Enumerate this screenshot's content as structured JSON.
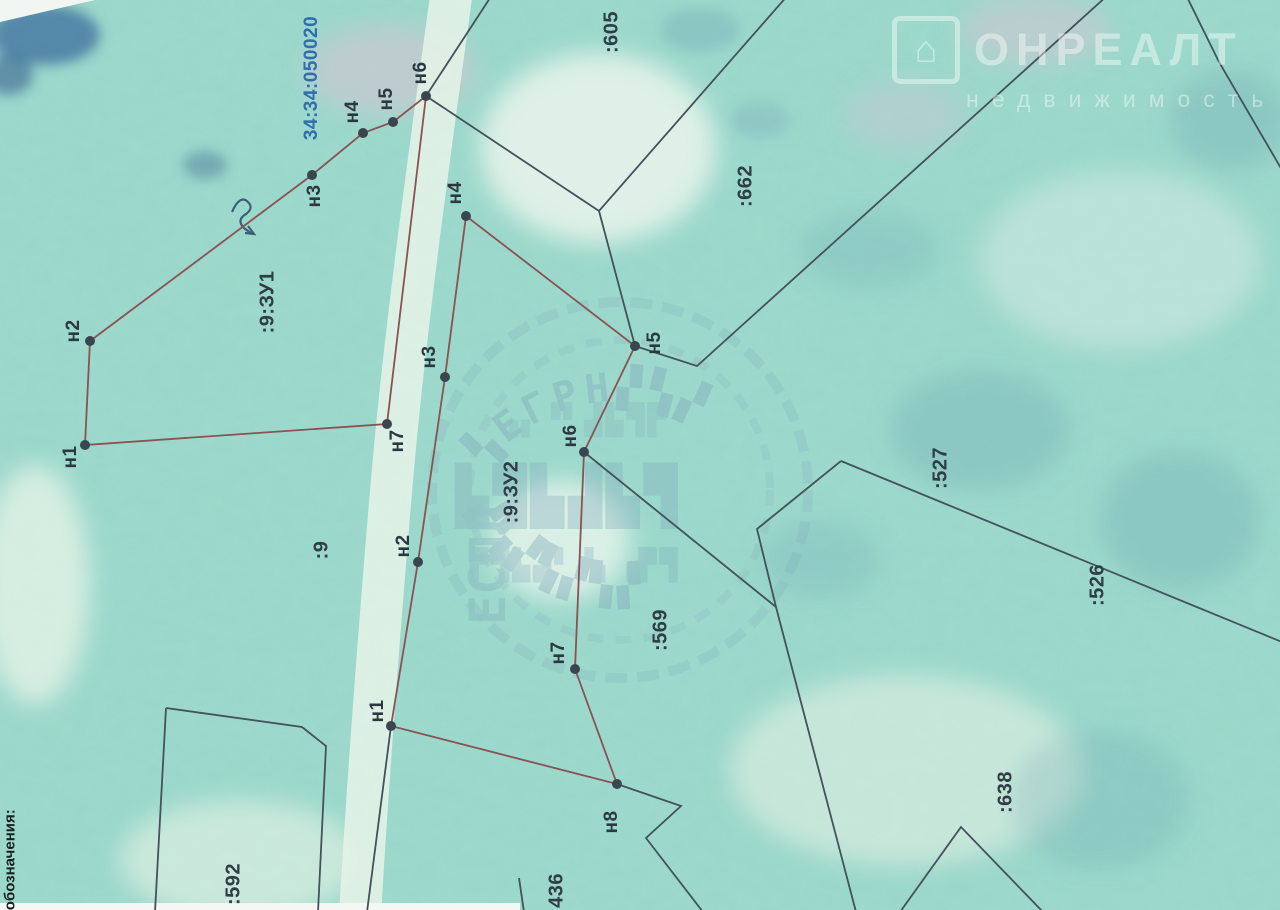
{
  "document": {
    "type": "scanned cadastral plan (rotated page)",
    "legend_fragment": "е обозначения:",
    "quarter_label": {
      "text": "34:34:050020",
      "x": 312,
      "y": 78,
      "color": "#2e6fae"
    }
  },
  "watermark_logo": {
    "word": "ОНРЕАЛТ",
    "tagline": "недвижимость",
    "icon": "house-icon"
  },
  "stamp": {
    "legible_text": "ЕГРН",
    "fragment_vertical": "ЕСПЛ",
    "decorative_blocks": "▙▜▟▛▞▚"
  },
  "colors": {
    "photo_teal": "#9ddacb",
    "line_existing": "#44525a",
    "line_new": "#8a5252",
    "dot": "#39464e",
    "label": "#2b3840",
    "quarter_blue": "#2e6fae",
    "stamp_blue": "#7fa8ba"
  },
  "map": {
    "parcel_labels": [
      {
        "text": ":9:ЗУ1",
        "x": 268,
        "y": 302
      },
      {
        "text": ":9",
        "x": 322,
        "y": 550
      },
      {
        "text": ":9:ЗУ2",
        "x": 512,
        "y": 492
      },
      {
        "text": ":569",
        "x": 661,
        "y": 630
      },
      {
        "text": ":605",
        "x": 612,
        "y": 32
      },
      {
        "text": ":662",
        "x": 746,
        "y": 186
      },
      {
        "text": ":527",
        "x": 941,
        "y": 468
      },
      {
        "text": ":526",
        "x": 1098,
        "y": 585
      },
      {
        "text": ":638",
        "x": 1006,
        "y": 792
      },
      {
        "text": ":592",
        "x": 234,
        "y": 884
      },
      {
        "text": ":436",
        "x": 557,
        "y": 894
      }
    ],
    "point_labels": [
      {
        "text": "н1",
        "x": 85,
        "y": 445,
        "lx": 71,
        "ly": 457
      },
      {
        "text": "н2",
        "x": 90,
        "y": 341,
        "lx": 74,
        "ly": 331
      },
      {
        "text": "н3",
        "x": 312,
        "y": 175,
        "lx": 315,
        "ly": 196
      },
      {
        "text": "н4",
        "x": 363,
        "y": 133,
        "lx": 353,
        "ly": 112
      },
      {
        "text": "н5",
        "x": 393,
        "y": 122,
        "lx": 387,
        "ly": 99
      },
      {
        "text": "н6",
        "x": 426,
        "y": 96,
        "lx": 421,
        "ly": 73
      },
      {
        "text": "н7",
        "x": 387,
        "y": 424,
        "lx": 398,
        "ly": 441
      },
      {
        "text": "н1",
        "x": 391,
        "y": 726,
        "lx": 378,
        "ly": 711
      },
      {
        "text": "н2",
        "x": 418,
        "y": 562,
        "lx": 404,
        "ly": 546
      },
      {
        "text": "н3",
        "x": 445,
        "y": 377,
        "lx": 430,
        "ly": 357
      },
      {
        "text": "н4",
        "x": 466,
        "y": 216,
        "lx": 456,
        "ly": 193
      },
      {
        "text": "н5",
        "x": 635,
        "y": 346,
        "lx": 655,
        "ly": 343
      },
      {
        "text": "н6",
        "x": 584,
        "y": 452,
        "lx": 571,
        "ly": 436
      },
      {
        "text": "н7",
        "x": 575,
        "y": 669,
        "lx": 559,
        "ly": 653
      },
      {
        "text": "н8",
        "x": 617,
        "y": 784,
        "lx": 612,
        "ly": 822
      }
    ],
    "new_boundaries": [
      {
        "name": "parcel-9-ZU1",
        "points": [
          [
            85,
            445
          ],
          [
            90,
            341
          ],
          [
            312,
            175
          ],
          [
            363,
            133
          ],
          [
            393,
            122
          ],
          [
            426,
            96
          ],
          [
            387,
            424
          ]
        ]
      },
      {
        "name": "parcel-9-ZU2",
        "points": [
          [
            391,
            726
          ],
          [
            418,
            562
          ],
          [
            445,
            377
          ],
          [
            466,
            216
          ],
          [
            635,
            346
          ],
          [
            584,
            452
          ],
          [
            575,
            669
          ],
          [
            617,
            784
          ]
        ]
      }
    ],
    "existing_boundaries": [
      [
        [
          492,
          -5
        ],
        [
          426,
          96
        ]
      ],
      [
        [
          426,
          96
        ],
        [
          599,
          211
        ],
        [
          788,
          -5
        ]
      ],
      [
        [
          599,
          211
        ],
        [
          635,
          346
        ]
      ],
      [
        [
          635,
          346
        ],
        [
          697,
          366
        ],
        [
          1108,
          -5
        ]
      ],
      [
        [
          1186,
          -5
        ],
        [
          1219,
          62
        ],
        [
          1282,
          170
        ]
      ],
      [
        [
          841,
          461
        ],
        [
          757,
          529
        ],
        [
          776,
          607
        ]
      ],
      [
        [
          584,
          452
        ],
        [
          776,
          607
        ]
      ],
      [
        [
          776,
          607
        ],
        [
          856,
          912
        ]
      ],
      [
        [
          841,
          461
        ],
        [
          1282,
          642
        ]
      ],
      [
        [
          900,
          912
        ],
        [
          961,
          827
        ],
        [
          1043,
          912
        ]
      ],
      [
        [
          391,
          726
        ],
        [
          367,
          912
        ]
      ],
      [
        [
          617,
          784
        ],
        [
          681,
          806
        ],
        [
          646,
          838
        ],
        [
          703,
          912
        ]
      ],
      [
        [
          166,
          708
        ],
        [
          302,
          727
        ],
        [
          326,
          746
        ],
        [
          318,
          912
        ]
      ],
      [
        [
          166,
          708
        ],
        [
          155,
          912
        ]
      ],
      [
        [
          519,
          878
        ],
        [
          524,
          912
        ]
      ]
    ]
  }
}
